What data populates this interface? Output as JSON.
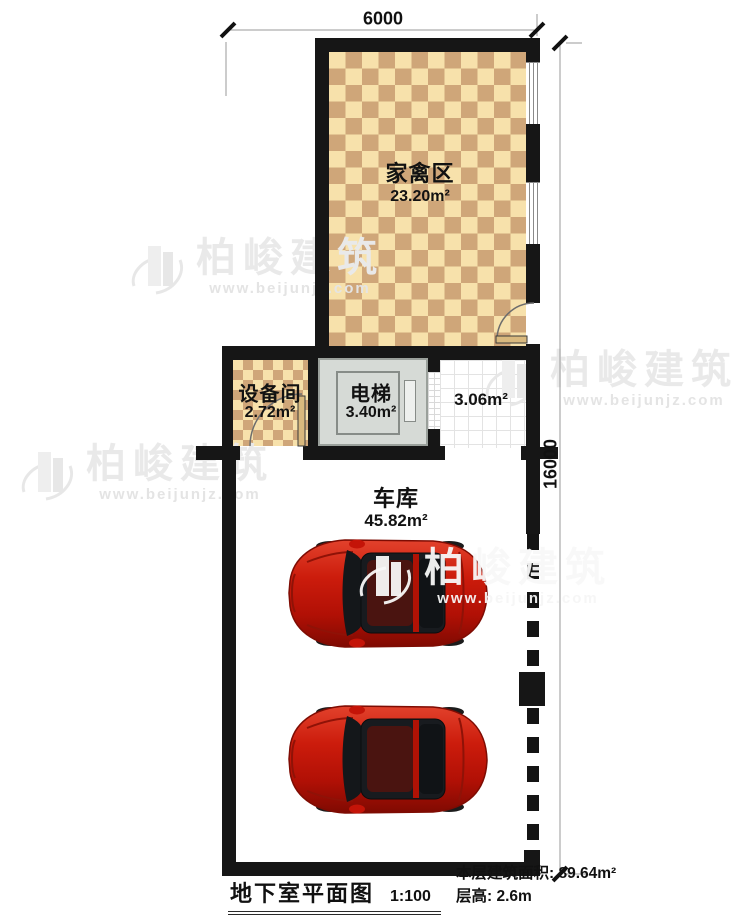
{
  "plan": {
    "rooms": [
      {
        "name": "家禽区",
        "area": "23.20m²"
      },
      {
        "name": "设备间",
        "area": "2.72m²"
      },
      {
        "name": "电梯",
        "area": "3.40m²"
      },
      {
        "name": "",
        "area": "3.06m²"
      },
      {
        "name": "车库",
        "area": "45.82m²"
      }
    ],
    "dimensions": {
      "top": "6000",
      "right": "16000"
    },
    "car_count": 2
  },
  "title_block": {
    "title": "地下室平面图",
    "scale": "1:100",
    "floor_area": "本层建筑面积: 89.64m²",
    "floor_height": "层高: 2.6m"
  },
  "watermark": {
    "brand": "柏峻建筑",
    "url": "www.beijunjz.com",
    "logo_icon": "building-logo-icon"
  },
  "colors": {
    "wall": "#161616",
    "checker_light": "#f7e1ab",
    "checker_dark": "#cfa679",
    "elevator_gray": "#d6dad6",
    "car_red": "#c41408",
    "dimension_line": "#999999",
    "watermark_gray": "#e9e9e9"
  }
}
